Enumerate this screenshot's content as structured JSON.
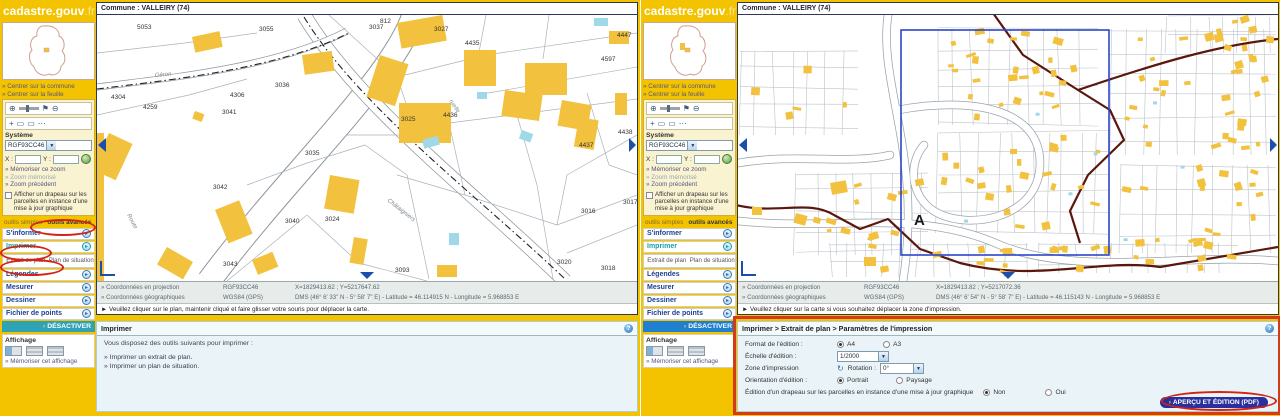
{
  "brand": {
    "logo_main": "cadastre.gouv",
    "logo_suffix": ".fr"
  },
  "icons": {
    "help": "?",
    "dropdown": "▼",
    "toggle": "▸",
    "deactivate_arrow": "›",
    "btn_arrow": "›",
    "refresh": "↻",
    "zoom_in": "⊕",
    "zoom_out": "⊖",
    "flag": "⚑",
    "arrow": "→",
    "move": "+",
    "select_rect": "▭",
    "dots": "⋯"
  },
  "sidebar": {
    "center_links": [
      "» Centrer sur la commune",
      "» Centrer sur la feuille"
    ],
    "system_label": "Système",
    "system_value": "RGF93CC46",
    "x_label": "X :",
    "y_label": "Y :",
    "zoom_links": [
      "» Mémoriser ce zoom",
      "» Zoom mémorisé",
      "» Zoom précédent"
    ],
    "flag_text": "Afficher un drapeau sur les parcelles en instance d'une mise à jour graphique",
    "tab_simple": "outils simples",
    "tab_advanced": "outils avancés",
    "sections": [
      "S'informer",
      "Imprimer",
      "Légendes",
      "Mesurer",
      "Dessiner",
      "Fichier de points"
    ],
    "sub_extrait": "Extrait de plan",
    "sub_plan": "Plan de situation",
    "deactivate_label": "DÉSACTIVER",
    "display_title": "Affichage",
    "display_link": "» Mémoriser cet affichage"
  },
  "left_view": {
    "window_title": "Commune : VALLEIRY (74)",
    "coords": {
      "row1_label": "» Coordonnées en projection",
      "row1_sys": "RGF93CC46",
      "row1_val": "X=1829413.62 ; Y=5217647.62",
      "row2_label": "» Coordonnées géographiques",
      "row2_sys": "WGS84 (GPS)",
      "row2_val": "DMS (46° 6' 33\" N - 5° 58' 7\" E) - Latitude = 46.114915 N - Longitude = 5.968853 E"
    },
    "status": "► Veuillez cliquer sur le plan, maintenir cliqué et faire glisser votre souris pour déplacer la carte.",
    "panel": {
      "title": "Imprimer",
      "intro": "Vous disposez des outils suivants pour imprimer :",
      "links": [
        "» Imprimer un extrait de plan.",
        "» Imprimer un plan de situation."
      ]
    },
    "map_labels": [
      {
        "t": "5053",
        "x": 40,
        "y": 14
      },
      {
        "t": "3055",
        "x": 162,
        "y": 16
      },
      {
        "t": "812",
        "x": 283,
        "y": 8
      },
      {
        "t": "3027",
        "x": 337,
        "y": 16
      },
      {
        "t": "4304",
        "x": 14,
        "y": 84
      },
      {
        "t": "4306",
        "x": 133,
        "y": 82
      },
      {
        "t": "4259",
        "x": 46,
        "y": 94
      },
      {
        "t": "3036",
        "x": 178,
        "y": 72
      },
      {
        "t": "3041",
        "x": 125,
        "y": 99
      },
      {
        "t": "3037",
        "x": 272,
        "y": 14
      },
      {
        "t": "4435",
        "x": 368,
        "y": 30
      },
      {
        "t": "4447",
        "x": 520,
        "y": 22
      },
      {
        "t": "4597",
        "x": 504,
        "y": 46
      },
      {
        "t": "3025",
        "x": 304,
        "y": 106
      },
      {
        "t": "4436",
        "x": 346,
        "y": 102
      },
      {
        "t": "4437",
        "x": 482,
        "y": 132
      },
      {
        "t": "4438",
        "x": 521,
        "y": 119
      },
      {
        "t": "3042",
        "x": 116,
        "y": 174
      },
      {
        "t": "3035",
        "x": 208,
        "y": 140
      },
      {
        "t": "3040",
        "x": 188,
        "y": 208
      },
      {
        "t": "3024",
        "x": 228,
        "y": 206
      },
      {
        "t": "3043",
        "x": 126,
        "y": 251
      },
      {
        "t": "3093",
        "x": 298,
        "y": 257
      },
      {
        "t": "3016",
        "x": 484,
        "y": 198
      },
      {
        "t": "3017",
        "x": 526,
        "y": 189
      },
      {
        "t": "3020",
        "x": 460,
        "y": 249
      },
      {
        "t": "3018",
        "x": 504,
        "y": 255
      }
    ],
    "road_labels": [
      {
        "t": "Géron",
        "x": 58,
        "y": 62,
        "r": -5
      },
      {
        "t": "Route",
        "x": 30,
        "y": 200,
        "r": 62
      },
      {
        "t": "ruelle",
        "x": 352,
        "y": 86,
        "r": 56
      },
      {
        "t": "Châtaigniers",
        "x": 290,
        "y": 186,
        "r": 38
      }
    ]
  },
  "right_view": {
    "window_title": "Commune : VALLEIRY (74)",
    "coords": {
      "row1_label": "» Coordonnées en projection",
      "row1_sys": "RGF93CC46",
      "row1_val": "X=1829413.82 ; Y=5217072.36",
      "row2_label": "» Coordonnées géographiques",
      "row2_sys": "WGS84 (GPS)",
      "row2_val": "DMS (46° 6' 54\" N - 5° 58' 7\" E) - Latitude = 46.115143 N - Longitude = 5.968853 E"
    },
    "status": "► Veuillez cliquer sur la carte si vous souhaitez déplacer la zone d'impression.",
    "section_label": "A",
    "print_zone": {
      "x": 163,
      "y": 15,
      "w": 208,
      "h": 225
    },
    "print_form": {
      "title": "Imprimer > Extrait de plan > Paramètres de l'impression",
      "format_label": "Format de l'édition :",
      "format_a4": "A4",
      "format_a3": "A3",
      "format_selected": "A4",
      "scale_label": "Échelle d'édition :",
      "scale_value": "1/2000",
      "zone_label": "Zone d'impression",
      "rotation_label": "Rotation :",
      "rotation_value": "0°",
      "orientation_label": "Orientation d'édition :",
      "portrait": "Portrait",
      "paysage": "Paysage",
      "orientation_selected": "Portrait",
      "flag_label": "Édition d'un drapeau sur les parcelles en instance d'une mise à jour graphique",
      "no": "Non",
      "yes": "Oui",
      "flag_selected": "Non",
      "submit_label": "APERÇU ET ÉDITION (PDF)"
    }
  }
}
